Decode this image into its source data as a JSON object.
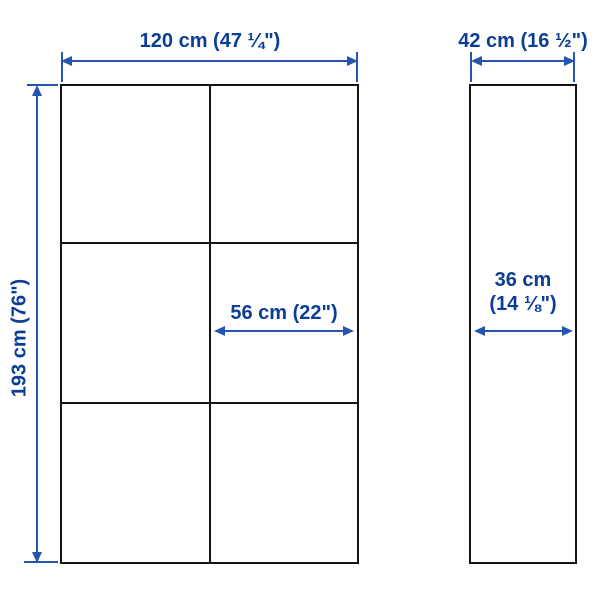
{
  "diagram": {
    "type": "product-dimension-diagram",
    "views": {
      "front": {
        "width_label": "120 cm (47 ¼\")",
        "height_label": "193 cm (76\")",
        "section_width_label": "56 cm (22\")",
        "grid": {
          "columns": 2,
          "rows": 3
        }
      },
      "side": {
        "depth_label": "42 cm (16 ½\")",
        "inner_depth_label_line1": "36 cm",
        "inner_depth_label_line2": "(14 ⅛\")"
      }
    },
    "colors": {
      "dimension_text": "#0a3e96",
      "dimension_line": "#2456b0",
      "outline": "#141414",
      "background": "#ffffff"
    }
  }
}
